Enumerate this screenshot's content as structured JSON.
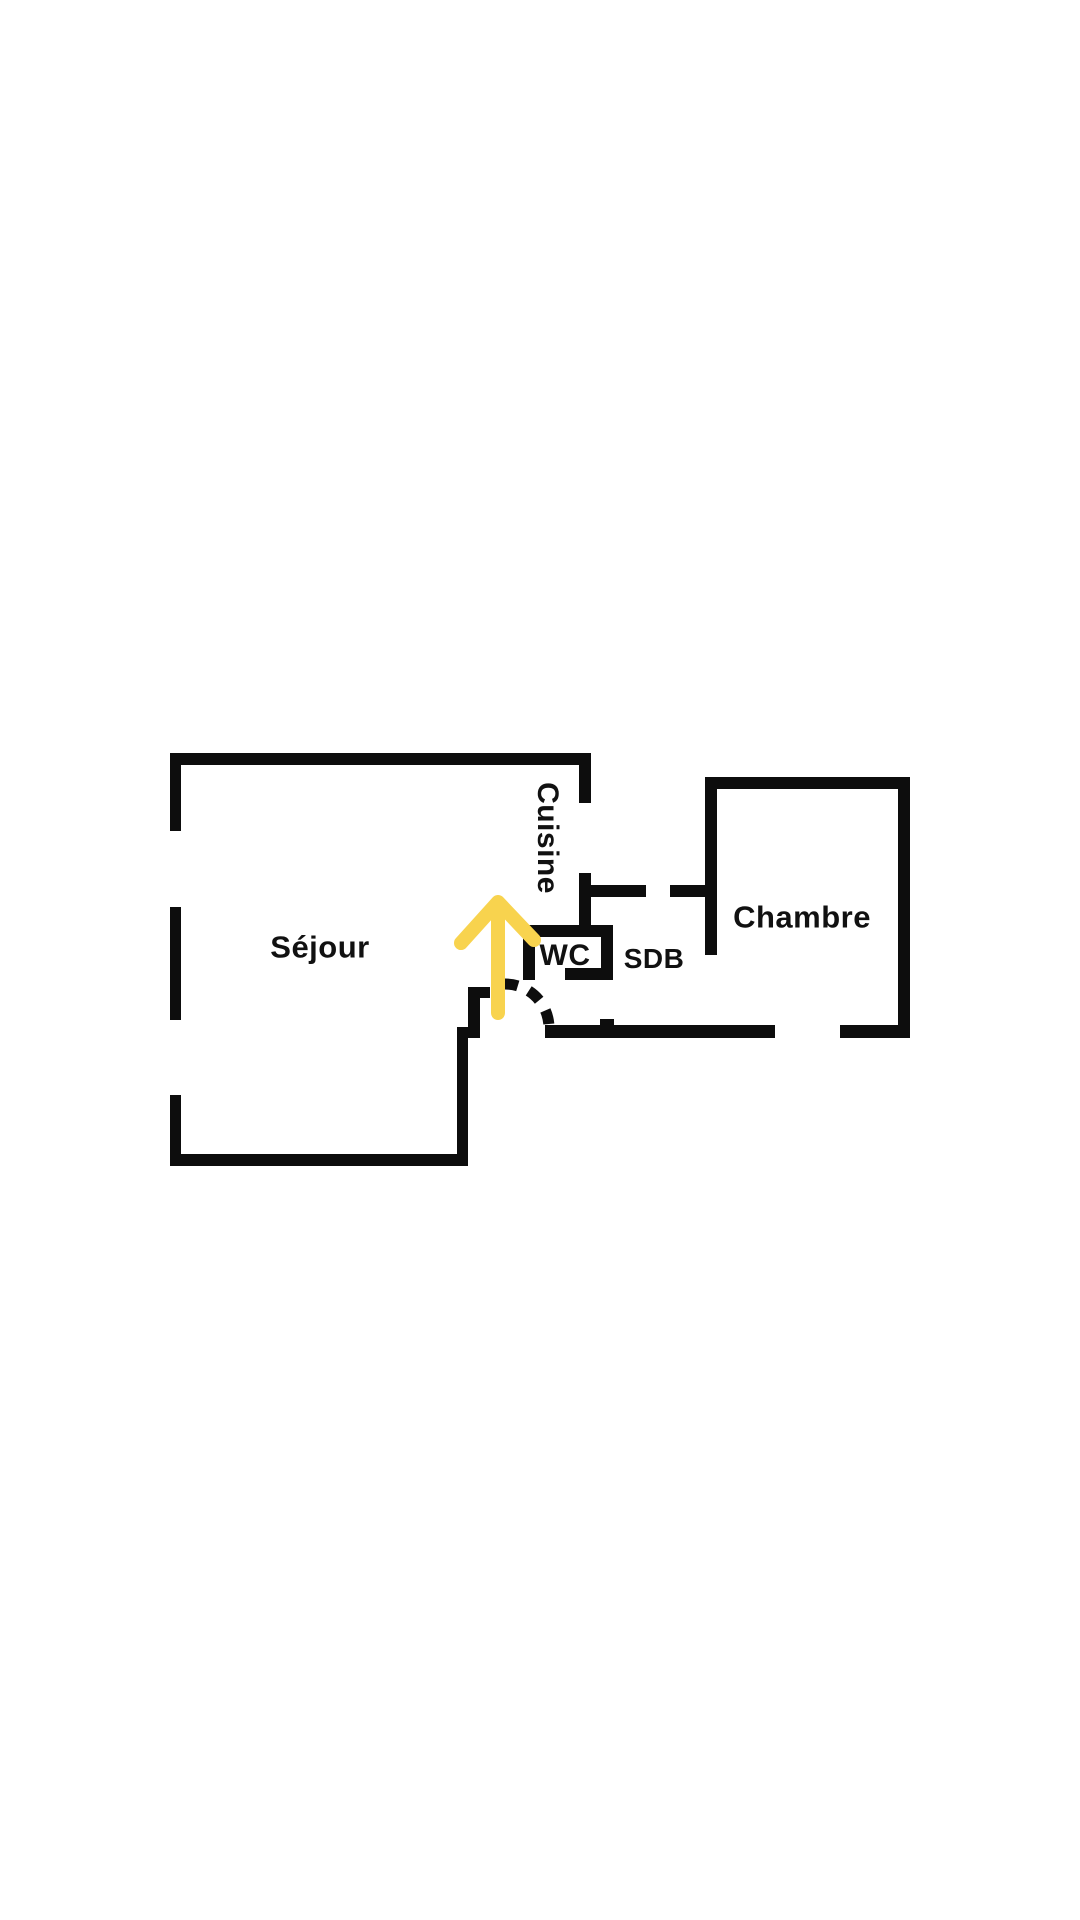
{
  "page": {
    "background": "#ffffff",
    "width": 1080,
    "height": 1920
  },
  "floorplan": {
    "rooms": {
      "sejour": {
        "label": "Séjour"
      },
      "cuisine": {
        "label": "Cuisine"
      },
      "wc": {
        "label": "WC"
      },
      "sdb": {
        "label": "SDB"
      },
      "chambre": {
        "label": "Chambre"
      }
    },
    "colors": {
      "wall": "#0d0d0d",
      "text": "#111111",
      "arrow": "#F8D34E",
      "background": "#ffffff"
    },
    "walls": [
      [
        170,
        753,
        421,
        12
      ],
      [
        170,
        753,
        11,
        78
      ],
      [
        170,
        907,
        11,
        113
      ],
      [
        170,
        1095,
        11,
        71
      ],
      [
        170,
        1154,
        298,
        12
      ],
      [
        457,
        1033,
        11,
        133
      ],
      [
        457,
        1027,
        23,
        11
      ],
      [
        468,
        987,
        12,
        46
      ],
      [
        468,
        987,
        22,
        11
      ],
      [
        579,
        753,
        12,
        50
      ],
      [
        579,
        873,
        12,
        57
      ],
      [
        579,
        885,
        67,
        12
      ],
      [
        670,
        885,
        47,
        12
      ],
      [
        705,
        777,
        12,
        178
      ],
      [
        705,
        777,
        205,
        12
      ],
      [
        898,
        777,
        12,
        260
      ],
      [
        545,
        1025,
        230,
        13
      ],
      [
        840,
        1025,
        70,
        13
      ],
      [
        600,
        1019,
        14,
        7
      ],
      [
        523,
        925,
        90,
        12
      ],
      [
        523,
        925,
        12,
        55
      ],
      [
        601,
        925,
        12,
        55
      ],
      [
        565,
        968,
        48,
        12
      ]
    ],
    "door_arc": {
      "start": [
        504,
        984
      ],
      "end": [
        549,
        1027
      ],
      "r": 44,
      "dash": [
        14,
        12
      ],
      "stroke_width": 11
    },
    "arrow": {
      "tip": [
        498,
        902
      ],
      "tail": [
        498,
        1013
      ],
      "left_wing": [
        461,
        943
      ],
      "right_wing": [
        534,
        940
      ],
      "stroke_width": 14
    }
  }
}
